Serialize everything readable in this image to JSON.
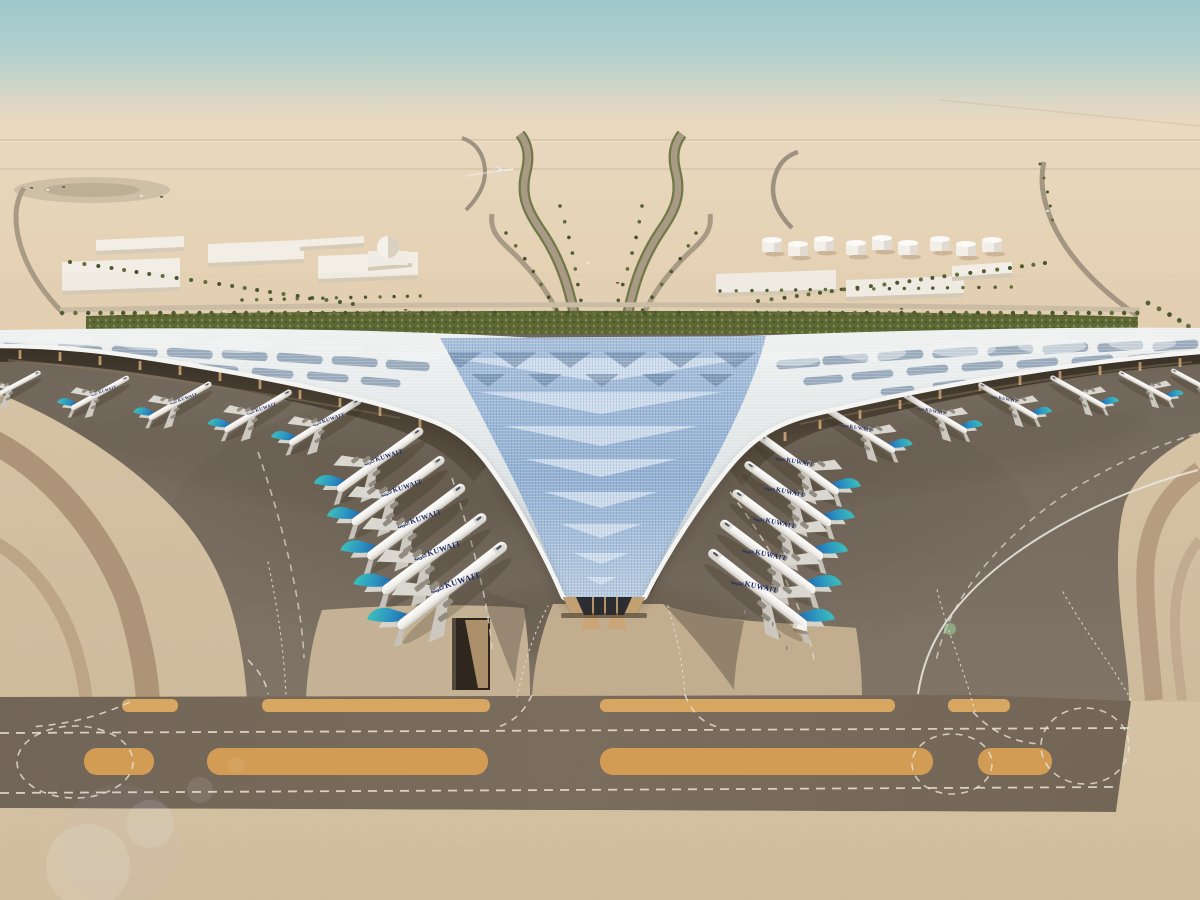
{
  "meta": {
    "type": "aerial-architectural-rendering",
    "subject": "airport-terminal-with-trefoil-roof"
  },
  "scene": {
    "airline_title": "KUWAIT",
    "airline_title_ar": "الكويتية",
    "colors": {
      "sky_top": "#9fc8cc",
      "sky_horizon": "#ead9c0",
      "desert": "#e4cfb0",
      "sand_foreground": "#d6c3a4",
      "apron": "#74695c",
      "taxiway_band": "#6f6355",
      "marking_white": "#e9e3d7",
      "marking_orange": "#dcaa62",
      "roof_white": "#eceeed",
      "roof_panel_blue": "#7e93ab",
      "roof_glass_blue": "#93b1d4",
      "landscape_green": "#55602f",
      "tail_teal": "#3fc4bc",
      "tail_blue": "#1d55a6",
      "fuselage_white": "#f2f1ee",
      "title_navy": "#1d2a63",
      "column_tan": "#c7a173"
    },
    "counts": {
      "aircraft_parked": 21,
      "aircraft_flying": 1,
      "fuel_tanks": 9
    },
    "aircraft": {
      "left_wing": [
        {
          "x": 14,
          "y": 386,
          "s": 0.6,
          "rot": -28,
          "label": false
        },
        {
          "x": 100,
          "y": 393,
          "s": 0.66,
          "rot": -29,
          "label": true
        },
        {
          "x": 180,
          "y": 401,
          "s": 0.72,
          "rot": -30,
          "label": true
        },
        {
          "x": 258,
          "y": 411,
          "s": 0.78,
          "rot": -31,
          "label": true
        },
        {
          "x": 325,
          "y": 422,
          "s": 0.84,
          "rot": -32,
          "label": true
        }
      ],
      "left_center": [
        {
          "x": 380,
          "y": 460,
          "s": 1.05,
          "rot": -36,
          "label": true
        },
        {
          "x": 398,
          "y": 491,
          "s": 1.13,
          "rot": -36,
          "label": true
        },
        {
          "x": 416,
          "y": 522,
          "s": 1.21,
          "rot": -37,
          "label": true
        },
        {
          "x": 434,
          "y": 554,
          "s": 1.29,
          "rot": -37,
          "label": true
        },
        {
          "x": 452,
          "y": 586,
          "s": 1.37,
          "rot": -38,
          "label": true
        }
      ],
      "right_center": [
        {
          "x": 798,
          "y": 464,
          "s": 1.0,
          "rot": -36,
          "label": true
        },
        {
          "x": 788,
          "y": 494,
          "s": 1.06,
          "rot": -36,
          "label": true
        },
        {
          "x": 778,
          "y": 525,
          "s": 1.12,
          "rot": -37,
          "label": true
        },
        {
          "x": 768,
          "y": 557,
          "s": 1.18,
          "rot": -37,
          "label": true
        },
        {
          "x": 758,
          "y": 589,
          "s": 1.24,
          "rot": -38,
          "label": true
        }
      ],
      "right_wing": [
        {
          "x": 860,
          "y": 430,
          "s": 0.82,
          "rot": -32,
          "label": true
        },
        {
          "x": 935,
          "y": 413,
          "s": 0.74,
          "rot": -31,
          "label": true
        },
        {
          "x": 1008,
          "y": 401,
          "s": 0.68,
          "rot": -30,
          "label": true
        },
        {
          "x": 1078,
          "y": 392,
          "s": 0.63,
          "rot": -29,
          "label": false
        },
        {
          "x": 1145,
          "y": 386,
          "s": 0.59,
          "rot": -28,
          "label": false
        },
        {
          "x": 1196,
          "y": 383,
          "s": 0.56,
          "rot": -28,
          "label": false
        }
      ],
      "flying": {
        "x": 505,
        "y": 170,
        "s": 0.55,
        "rot": -6
      }
    },
    "palm_rows": [
      [
        62,
        313,
        1138,
        313,
        88,
        2.2
      ],
      [
        70,
        262,
        352,
        304,
        22,
        2.0
      ],
      [
        758,
        301,
        1046,
        263,
        24,
        2.0
      ],
      [
        560,
        206,
        586,
        316,
        8,
        1.8
      ],
      [
        642,
        206,
        616,
        316,
        8,
        1.8
      ],
      [
        506,
        233,
        558,
        310,
        7,
        1.8
      ],
      [
        696,
        233,
        644,
        310,
        7,
        1.8
      ],
      [
        1148,
        303,
        1198,
        332,
        6,
        2.4
      ],
      [
        720,
        291,
        1010,
        287,
        20,
        1.7
      ],
      [
        242,
        300,
        420,
        296,
        14,
        1.7
      ],
      [
        1040,
        164,
        1052,
        220,
        5,
        1.5
      ]
    ],
    "fuel_tanks": [
      [
        772,
        246
      ],
      [
        798,
        250
      ],
      [
        824,
        245
      ],
      [
        856,
        249
      ],
      [
        882,
        244
      ],
      [
        908,
        249
      ],
      [
        940,
        245
      ],
      [
        966,
        250
      ],
      [
        992,
        246
      ]
    ],
    "buildings": [
      [
        62,
        258,
        118,
        34
      ],
      [
        96,
        236,
        88,
        16
      ],
      [
        208,
        240,
        96,
        24
      ],
      [
        318,
        252,
        100,
        28
      ],
      [
        300,
        236,
        64,
        12
      ],
      [
        716,
        270,
        120,
        24
      ],
      [
        846,
        276,
        118,
        22
      ],
      [
        952,
        262,
        60,
        16
      ],
      [
        368,
        252,
        44,
        16
      ]
    ],
    "dome": {
      "x": 388,
      "y": 247,
      "r": 11
    },
    "roof_panels": {
      "rows": [
        {
          "h": 9,
          "rot": 4,
          "items": [
            [
              25,
              344,
              46
            ],
            [
              80,
              345,
              46
            ],
            [
              135,
              347,
              46
            ],
            [
              190,
              349,
              46
            ],
            [
              245,
              351,
              46
            ],
            [
              300,
              354,
              46
            ],
            [
              355,
              357,
              46
            ],
            [
              408,
              361,
              44
            ]
          ]
        },
        {
          "h": 8,
          "rot": 5,
          "items": [
            [
              53,
              357,
              42
            ],
            [
              108,
              359,
              42
            ],
            [
              163,
              362,
              42
            ],
            [
              218,
              365,
              42
            ],
            [
              273,
              369,
              42
            ],
            [
              328,
              373,
              42
            ],
            [
              381,
              378,
              40
            ]
          ]
        },
        {
          "h": 7,
          "rot": 6,
          "items": [
            [
              85,
              371,
              36
            ],
            [
              140,
              374,
              36
            ],
            [
              195,
              378,
              36
            ],
            [
              250,
              383,
              36
            ],
            [
              303,
              389,
              34
            ]
          ]
        },
        {
          "h": 9,
          "rot": -4,
          "items": [
            [
              1175,
              341,
              46
            ],
            [
              1120,
              342,
              46
            ],
            [
              1065,
              344,
              46
            ],
            [
              1010,
              346,
              46
            ],
            [
              955,
              348,
              46
            ],
            [
              900,
              351,
              46
            ],
            [
              845,
              355,
              46
            ],
            [
              798,
              359,
              44
            ]
          ]
        },
        {
          "h": 8,
          "rot": -5,
          "items": [
            [
              1147,
              354,
              42
            ],
            [
              1092,
              356,
              42
            ],
            [
              1037,
              359,
              42
            ],
            [
              982,
              362,
              42
            ],
            [
              927,
              366,
              42
            ],
            [
              872,
              371,
              42
            ],
            [
              823,
              376,
              40
            ]
          ]
        },
        {
          "h": 7,
          "rot": -6,
          "items": [
            [
              1115,
              368,
              36
            ],
            [
              1060,
              372,
              36
            ],
            [
              1005,
              376,
              36
            ],
            [
              950,
              381,
              36
            ],
            [
              897,
              387,
              34
            ]
          ]
        }
      ]
    },
    "roof_chevrons_light": [
      [
        601,
        358,
        150,
        24
      ],
      [
        601,
        392,
        122,
        22
      ],
      [
        601,
        426,
        97,
        20
      ],
      [
        601,
        459,
        76,
        18
      ],
      [
        601,
        492,
        57,
        16
      ],
      [
        601,
        524,
        41,
        14
      ],
      [
        601,
        553,
        28,
        11
      ],
      [
        601,
        577,
        16,
        8
      ]
    ],
    "roof_diamonds_dark": [
      [
        460,
        352,
        44,
        16
      ],
      [
        515,
        352,
        44,
        16
      ],
      [
        570,
        352,
        44,
        16
      ],
      [
        625,
        352,
        44,
        16
      ],
      [
        680,
        352,
        44,
        16
      ],
      [
        735,
        352,
        44,
        16
      ],
      [
        488,
        374,
        34,
        13
      ],
      [
        545,
        374,
        34,
        13
      ],
      [
        602,
        374,
        34,
        13
      ],
      [
        659,
        374,
        34,
        13
      ],
      [
        716,
        374,
        34,
        13
      ]
    ],
    "roof_domes": [
      [
        60,
        340,
        34,
        8
      ],
      [
        150,
        342,
        34,
        8
      ],
      [
        240,
        345,
        34,
        8
      ],
      [
        330,
        349,
        34,
        8
      ],
      [
        418,
        353,
        32,
        8
      ],
      [
        1142,
        343,
        34,
        8
      ],
      [
        1052,
        346,
        34,
        8
      ],
      [
        962,
        349,
        34,
        8
      ],
      [
        872,
        353,
        34,
        8
      ],
      [
        792,
        358,
        30,
        8
      ]
    ],
    "canopy_columns": [
      [
        20,
        350
      ],
      [
        60,
        352
      ],
      [
        100,
        356
      ],
      [
        140,
        361
      ],
      [
        180,
        366
      ],
      [
        220,
        372
      ],
      [
        260,
        380
      ],
      [
        300,
        390
      ],
      [
        340,
        398
      ],
      [
        380,
        407
      ],
      [
        420,
        419
      ],
      [
        1180,
        358
      ],
      [
        1140,
        362
      ],
      [
        1100,
        366
      ],
      [
        1060,
        371
      ],
      [
        1020,
        376
      ],
      [
        980,
        382
      ],
      [
        940,
        390
      ],
      [
        900,
        400
      ],
      [
        860,
        410
      ],
      [
        820,
        420
      ],
      [
        785,
        432
      ]
    ],
    "markings": {
      "orange_upper": [
        [
          122,
          178
        ],
        [
          262,
          490
        ],
        [
          600,
          895
        ],
        [
          948,
          1010
        ]
      ],
      "orange_lower": [
        [
          84,
          154
        ],
        [
          207,
          488
        ],
        [
          600,
          933
        ],
        [
          978,
          1052
        ]
      ],
      "upper_y": 699,
      "upper_h": 13,
      "lower_y": 748,
      "lower_h": 27,
      "dash_h": [
        [
          0,
          733,
          1130,
          728
        ],
        [
          0,
          793,
          1118,
          787
        ]
      ],
      "dotted_curves": [
        "M268,562 C278,610 284,650 286,697",
        "M937,590 C950,640 965,672 975,712",
        "M1063,592 C1090,640 1115,668 1132,702",
        "M517,697 C525,660 535,630 548,606",
        "M668,606 C678,640 683,665 685,697"
      ],
      "dashed_loops": [
        [
          75,
          762,
          58,
          36
        ],
        [
          952,
          764,
          40,
          30
        ],
        [
          1085,
          746,
          44,
          38
        ]
      ],
      "dashed_arcs": [
        "M130,702 C100,716 70,724 30,727",
        "M973,712 C990,730 1010,742 1040,744",
        "M532,695 C525,710 515,722 495,728",
        "M685,695 C692,712 702,724 722,728",
        "M248,660 C260,672 266,682 268,694"
      ],
      "taxi_dashed": [
        "M258,452 C288,540 302,610 304,658",
        "M1196,434 C1100,462 1014,520 968,588 C950,615 940,640 936,662",
        "M730,492 C778,556 806,614 814,660",
        "M452,478 C472,540 488,600 492,650"
      ],
      "taxi_solid": [
        "M1198,470 C1086,500 990,558 946,622 C930,646 922,668 918,694"
      ]
    },
    "vehicles": {
      "apron_bus": {
        "x": 800,
        "y": 627,
        "rot": 15
      },
      "posts": [
        [
          772,
          622
        ],
        [
          779,
          634
        ],
        [
          786,
          646
        ],
        [
          744,
          610
        ]
      ],
      "distant": [
        [
          222,
          311
        ],
        [
          404,
          309
        ],
        [
          700,
          309
        ],
        [
          900,
          308
        ],
        [
          586,
          262
        ],
        [
          616,
          282
        ],
        [
          1046,
          210
        ],
        [
          30,
          187
        ],
        [
          46,
          189
        ],
        [
          62,
          186
        ],
        [
          140,
          195
        ],
        [
          160,
          196
        ]
      ]
    },
    "flare": [
      [
        88,
        866,
        42,
        0.13,
        "#ffffff"
      ],
      [
        150,
        824,
        24,
        0.11,
        "#ffffff"
      ],
      [
        200,
        790,
        13,
        0.09,
        "#ffffff"
      ],
      [
        236,
        765,
        8,
        0.07,
        "#ffffff"
      ],
      [
        120,
        845,
        60,
        0.07,
        "#c8b6e2"
      ],
      [
        950,
        629,
        6,
        0.45,
        "#a6e6ac"
      ]
    ]
  }
}
